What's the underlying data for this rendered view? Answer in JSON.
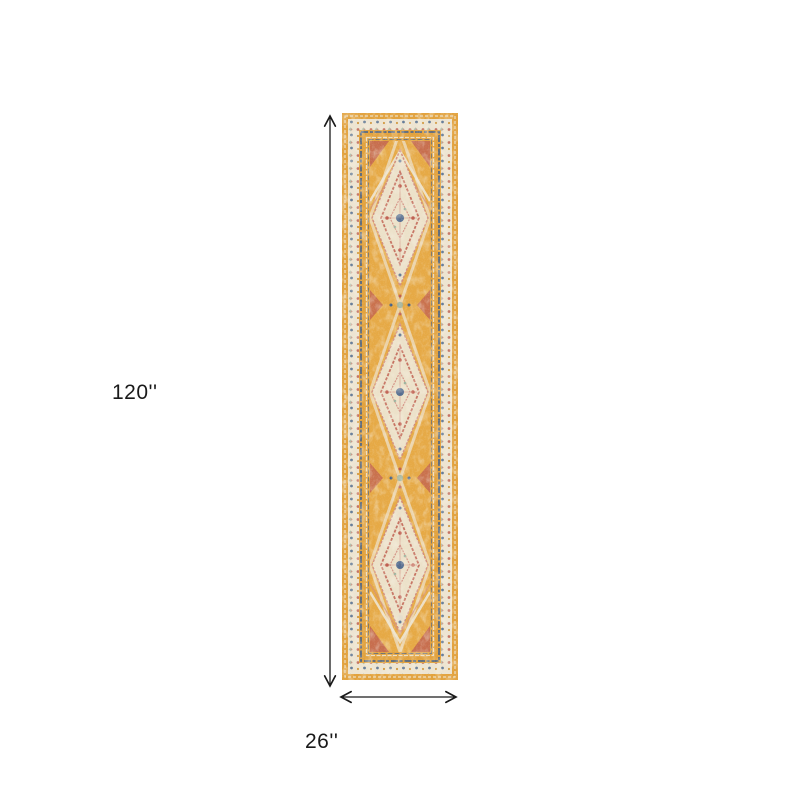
{
  "diagram": {
    "background": "#ffffff",
    "arrow_color": "#1a1a1a",
    "height_label": "120''",
    "width_label": "26''"
  },
  "rug": {
    "description": "vintage distressed runner rug, gold field with ivory diamond medallions and blue border lines",
    "colors": {
      "gold": "#e2a23e",
      "gold2": "#e6a945",
      "gold_deep": "#cf8f2e",
      "ivory": "#ede4d1",
      "blue": "#44618a",
      "rust": "#bf5f50",
      "pink": "#d18b7e",
      "sage": "#9fb49f"
    }
  }
}
